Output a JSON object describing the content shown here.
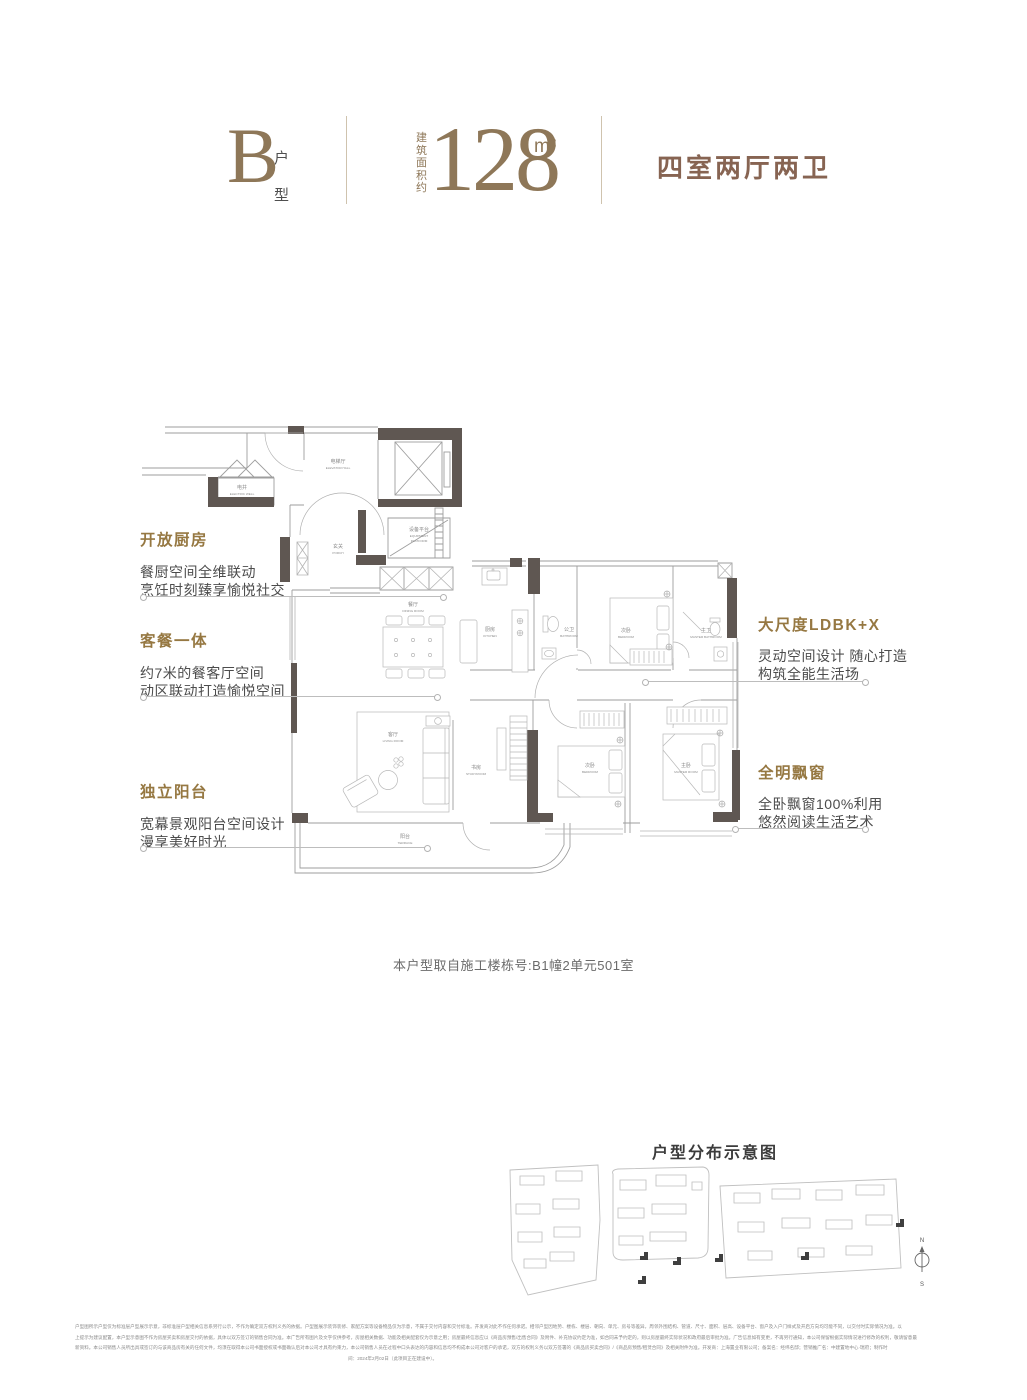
{
  "header": {
    "type_letter": "B",
    "type_label": "户型",
    "area_prefix": "建筑面积约",
    "area_value": "128",
    "area_unit": "m²",
    "layout": "四室两厅两卫"
  },
  "annotations": {
    "left": [
      {
        "title": "开放厨房",
        "lines": [
          "餐厨空间全维联动",
          "烹饪时刻臻享愉悦社交"
        ]
      },
      {
        "title": "客餐一体",
        "lines": [
          "约7米的餐客厅空间",
          "动区联动打造愉悦空间"
        ]
      },
      {
        "title": "独立阳台",
        "lines": [
          "宽幕景观阳台空间设计",
          "漫享美好时光"
        ]
      }
    ],
    "right": [
      {
        "title": "大尺度LDBK+X",
        "lines": [
          "灵动空间设计 随心打造",
          "构筑全能生活场"
        ]
      },
      {
        "title": "全明飘窗",
        "lines": [
          "全卧飘窗100%利用",
          "悠然阅读生活艺术"
        ]
      }
    ]
  },
  "floorplan": {
    "rooms": [
      {
        "cn": "电梯厅",
        "en": "ELEVATOR HALL"
      },
      {
        "cn": "电井",
        "en": "ELECTRIC WELL"
      },
      {
        "cn": "设备平台",
        "en1": "EQUIPMENT",
        "en2": "PLATFORM"
      },
      {
        "cn": "玄关",
        "en": "PORCH"
      },
      {
        "cn": "餐厅",
        "en": "DINING ROOM"
      },
      {
        "cn": "厨房",
        "en": "KITCHEN"
      },
      {
        "cn": "公卫",
        "en": "BATHROOM"
      },
      {
        "cn": "次卧",
        "en": "BEDROOM"
      },
      {
        "cn": "主卫",
        "en": "MASTER BATHROOM"
      },
      {
        "cn": "客厅",
        "en": "LIVING ROOM"
      },
      {
        "cn": "书房",
        "en": "STUDYROOM"
      },
      {
        "cn": "次卧",
        "en": "BEDROOM"
      },
      {
        "cn": "主卧",
        "en": "MASTER ROOM"
      },
      {
        "cn": "阳台",
        "en": "TERRACE"
      }
    ]
  },
  "caption": "本户型取自施工楼栋号:B1幢2单元501室",
  "siteplan": {
    "title": "户型分布示意图",
    "compass_n": "N",
    "compass_s": "S"
  },
  "disclaimer": {
    "lines": [
      "户型图所示户型仅为标准层户型展示示意，非标准层户型相关信息系另行公示，不作为确定双方权利义务的依据。户型图展示装饰装修、家配方案等设备物品仅为示意，不属于交付内容和交付标准。开发商对此不作任何承诺。相邻户型因地势、楼栋、楼层、朝向、单元、房号等差异，周邻外围结构、管道、尺寸、面积、层高、设备平台、窗户及入户门样式及开启方向均可能不同，以交付时实际情况为准。以",
      "上提示为建议配置，本户型示意图不作为房屋买卖和房屋交付的依据，具体以双方签订的销售合同为准。本广告所有图片及文字仅供参考，房屋相关数据、功能及相关配套仅为示意之用；房屋最终信息应以《商品房预售/出售合同》及附件、补充协议约定为准，如合同未予约定的，则以房屋最终实际状况和政府最后审批为准。广告信息如有变更，不再另行通知，本公司保留根据实际情况进行修改的权利，敬请留意最",
      "新资料。本公司销售人员所出具或签订的与该商品房有关的任何文件，均须在取得本公司书面授权或书面确认后对本公司才具有约束力，本公司销售人员在过程中口头表达的内容和信息均不构成本公司对客户的承诺，双方的权利义务以双方签署的《商品房买卖合同》/《商品房预售/租赁合同》及相关附件为准。开发商：上海置业有限公司；备案名：经纬名邸；营销推广名：中建置地中心·瑞府；制作时",
      "间：2024年2月02日（此项目正在建设中）。"
    ]
  },
  "colors": {
    "accent_gold": "#8E7758",
    "title_brown": "#876452",
    "annotation_gold": "#967842",
    "body_text": "#4c4c4c",
    "wall_dark": "#5f5752",
    "line_gray": "#9e9e9e"
  }
}
